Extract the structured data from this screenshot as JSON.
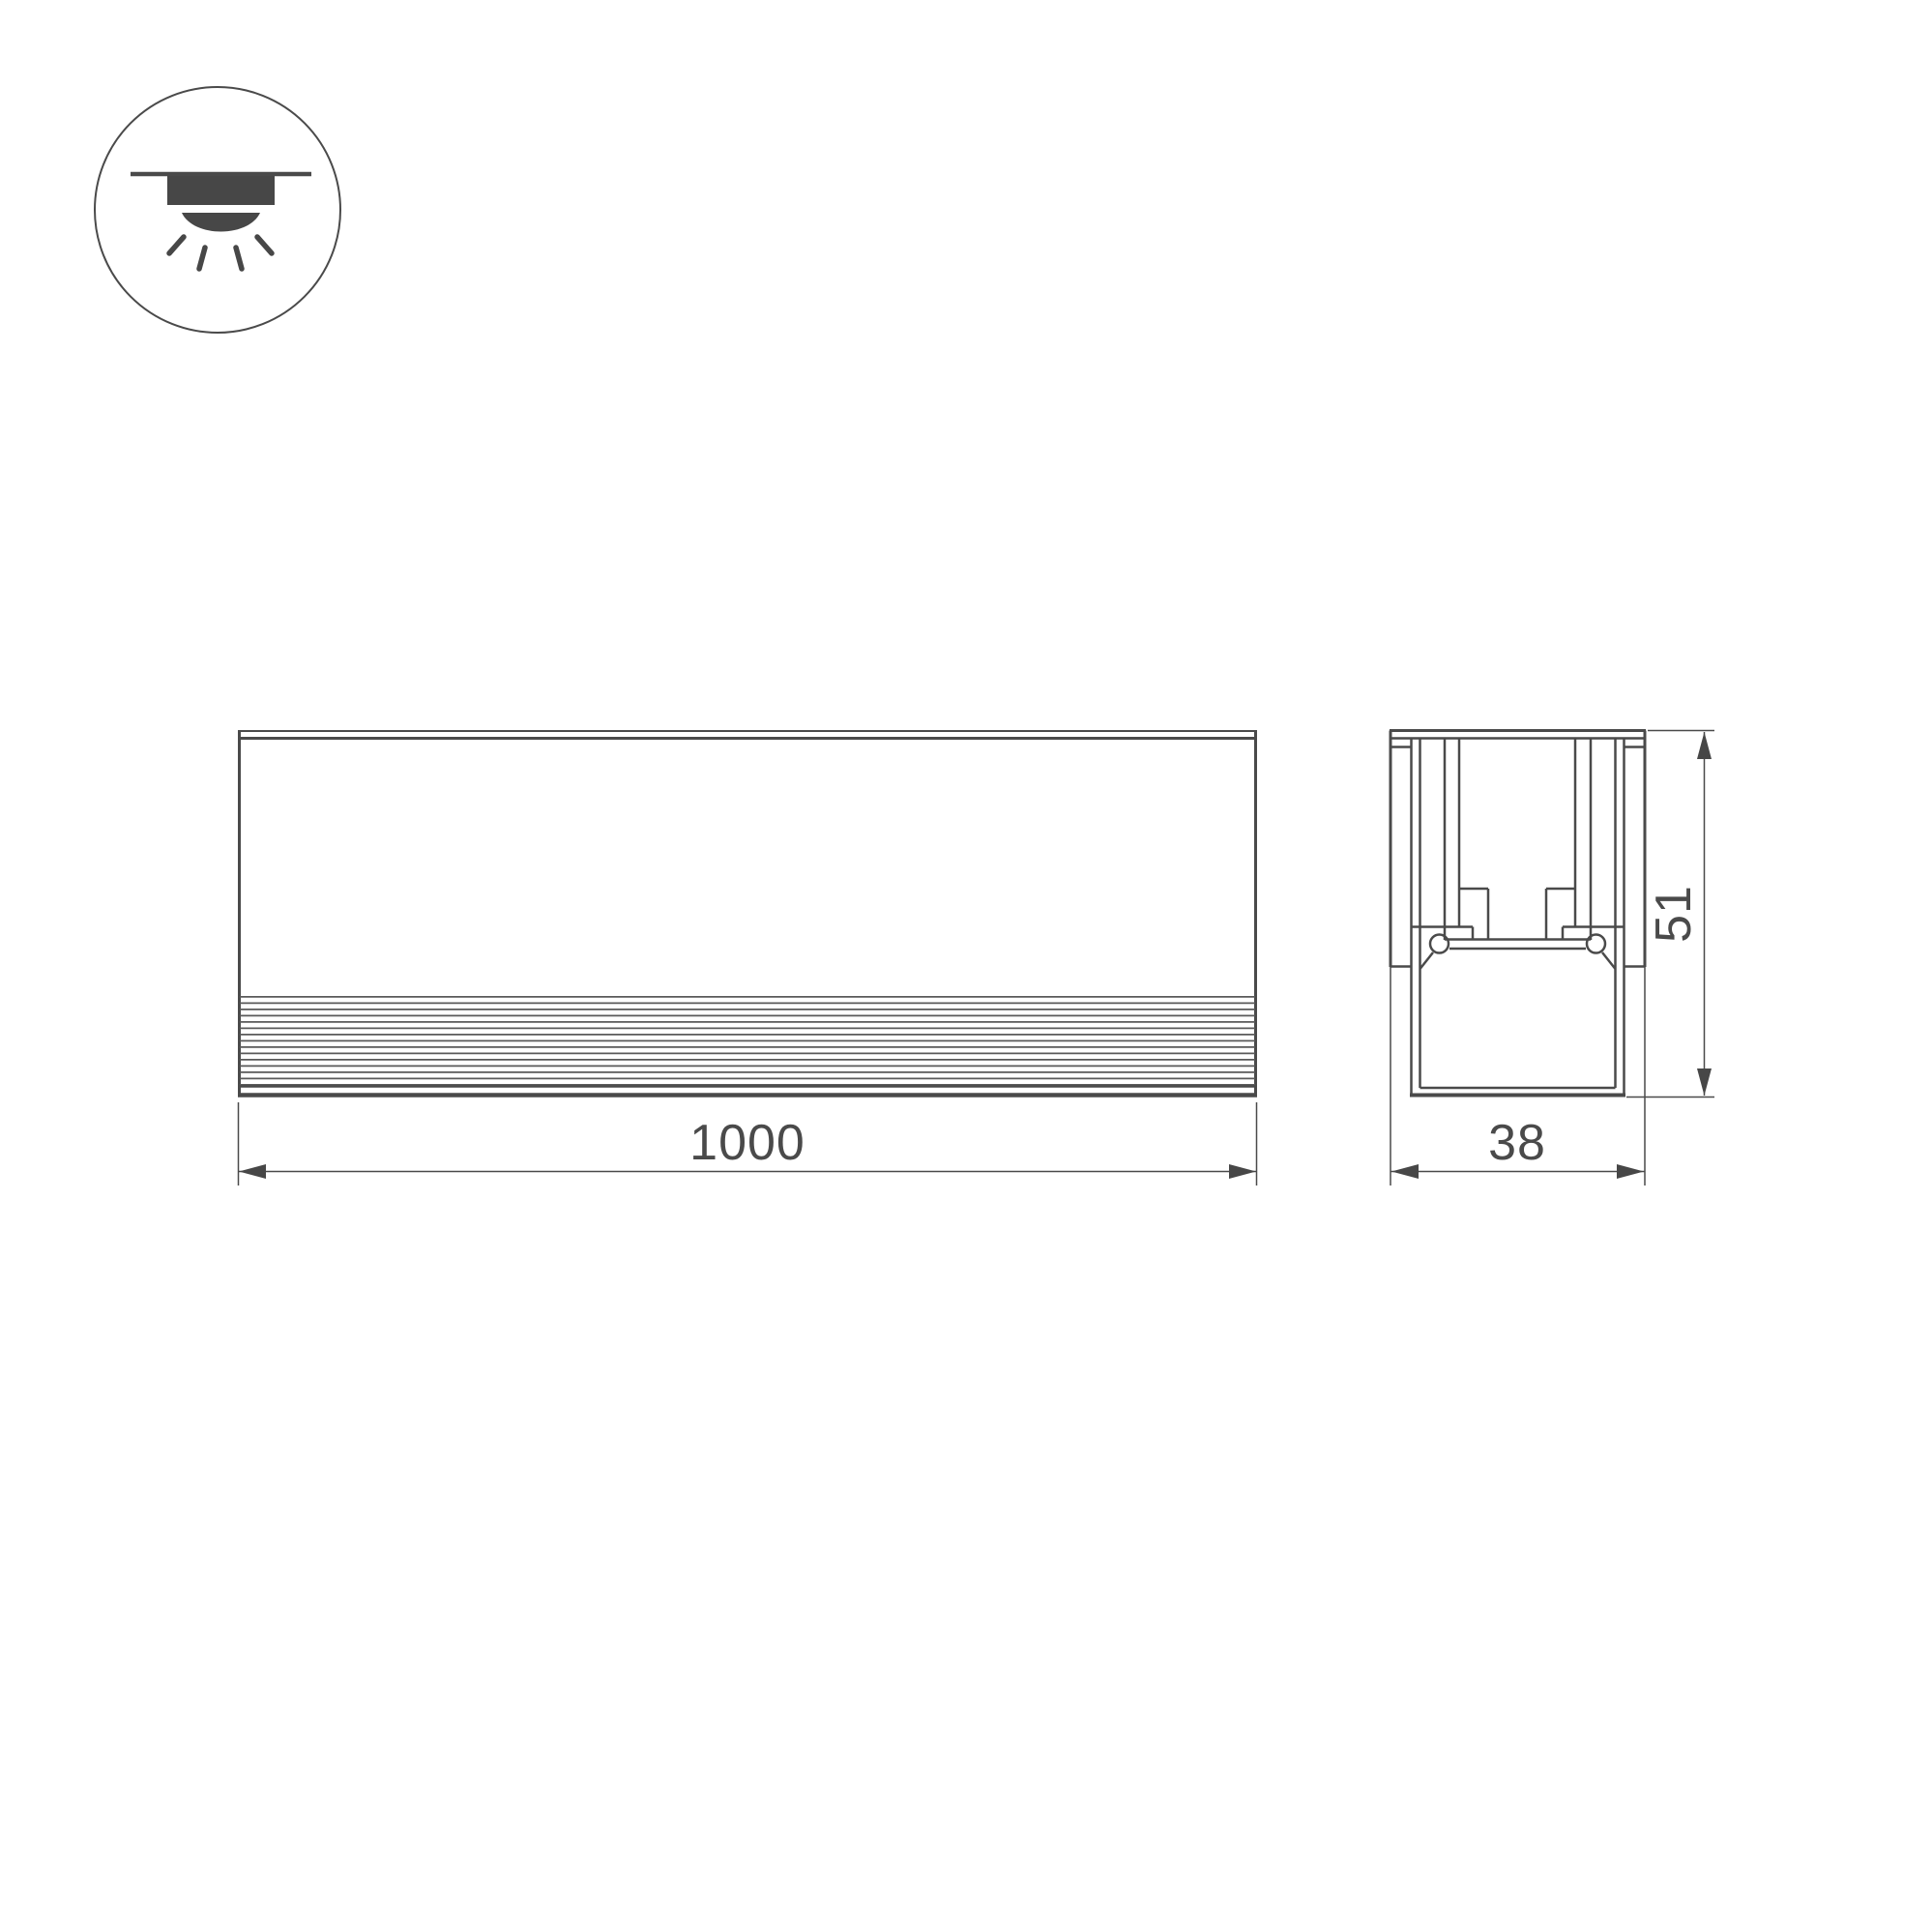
{
  "icon": {
    "name": "recessed-ceiling-light",
    "description": "circle badge with recessed downlight glyph and light rays"
  },
  "dimensions": {
    "length": {
      "value": "1000"
    },
    "width": {
      "value": "38"
    },
    "height": {
      "value": "51"
    }
  },
  "colors": {
    "line": "#4a4a4a",
    "icon_fill": "#474747",
    "rib_line": "#5a5a5a",
    "background": "#ffffff"
  }
}
